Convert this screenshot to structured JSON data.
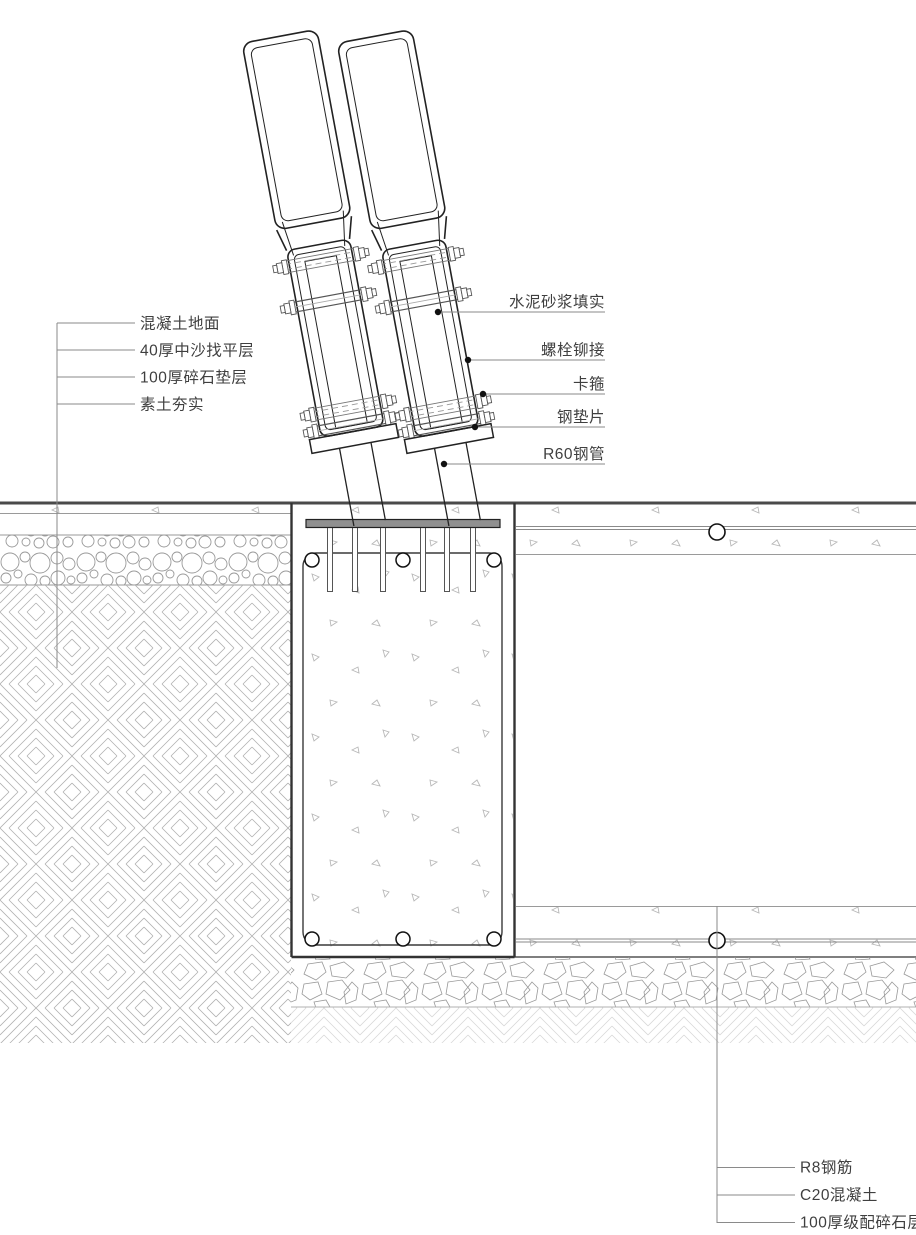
{
  "drawing_title": "栏杆立柱基础做法详图",
  "labels": {
    "left": [
      {
        "text": "混凝土地面"
      },
      {
        "text": "40厚中沙找平层"
      },
      {
        "text": "100厚碎石垫层"
      },
      {
        "text": "素土夯实"
      }
    ],
    "right": [
      {
        "text": "水泥砂浆填实"
      },
      {
        "text": "螺栓铆接"
      },
      {
        "text": "卡箍"
      },
      {
        "text": "钢垫片"
      },
      {
        "text": "R60钢管"
      }
    ],
    "bottom_right": [
      {
        "text": "R8钢筋"
      },
      {
        "text": "C20混凝土"
      },
      {
        "text": "100厚级配碎石层"
      }
    ]
  },
  "colors": {
    "line_dark": "#222222",
    "line_medium": "#555555",
    "line_light": "#9a9a9a",
    "hatch": "#b0b0b0",
    "plate_fill": "#909090",
    "background": "#ffffff"
  }
}
